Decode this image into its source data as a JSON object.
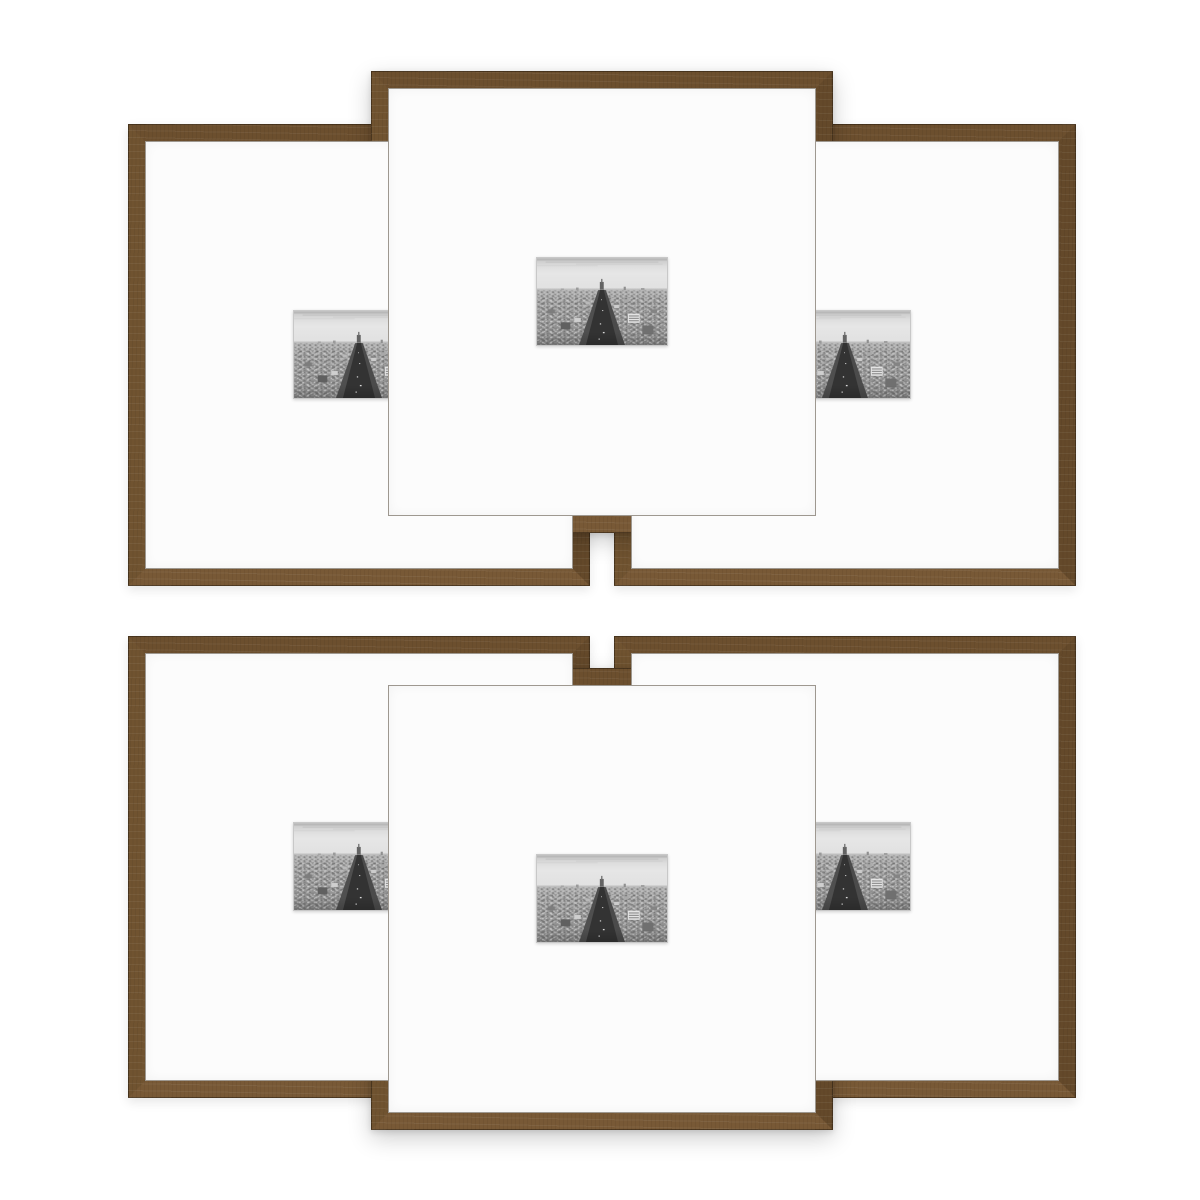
{
  "scene": {
    "type": "product-photo",
    "description": "Six-piece set of square walnut-brown gallery picture frames with wide white mats, overlapping in two rows of three on a white background; every mat opening shows the same black-and-white aerial photograph of a long tree-lined Paris avenue receding to the horizon.",
    "background_color": "#ffffff"
  },
  "product": {
    "frame_count": 6,
    "frame_finish": "walnut brown wood",
    "mat_color": "white",
    "artwork_subject": "black-and-white aerial view of the Champs-Elysees, Paris"
  },
  "theme": {
    "background": "#ffffff",
    "wood-top": "#6c4f2e",
    "wood-right": "#64492a",
    "wood-bottom": "#785936",
    "wood-left": "#705330",
    "wood-edge": "rgba(44,31,16,0.55)",
    "mat": "#fcfcfc",
    "photo-border": "#c8c8c8"
  },
  "frames": [
    {
      "id": "top-left",
      "layer": "back",
      "aria_label": "Walnut frame with white mat, top row left, partly behind center frame"
    },
    {
      "id": "top-right",
      "layer": "back",
      "aria_label": "Walnut frame with white mat, top row right, partly behind center frame"
    },
    {
      "id": "top-center",
      "layer": "front",
      "aria_label": "Walnut frame with white mat, top row center, in front"
    },
    {
      "id": "bottom-left",
      "layer": "back",
      "aria_label": "Walnut frame with white mat, bottom row left, partly behind center frame"
    },
    {
      "id": "bottom-right",
      "layer": "back",
      "aria_label": "Walnut frame with white mat, bottom row right, partly behind center frame"
    },
    {
      "id": "bottom-center",
      "layer": "front",
      "aria_label": "Walnut frame with white mat, bottom row center, in front"
    }
  ]
}
